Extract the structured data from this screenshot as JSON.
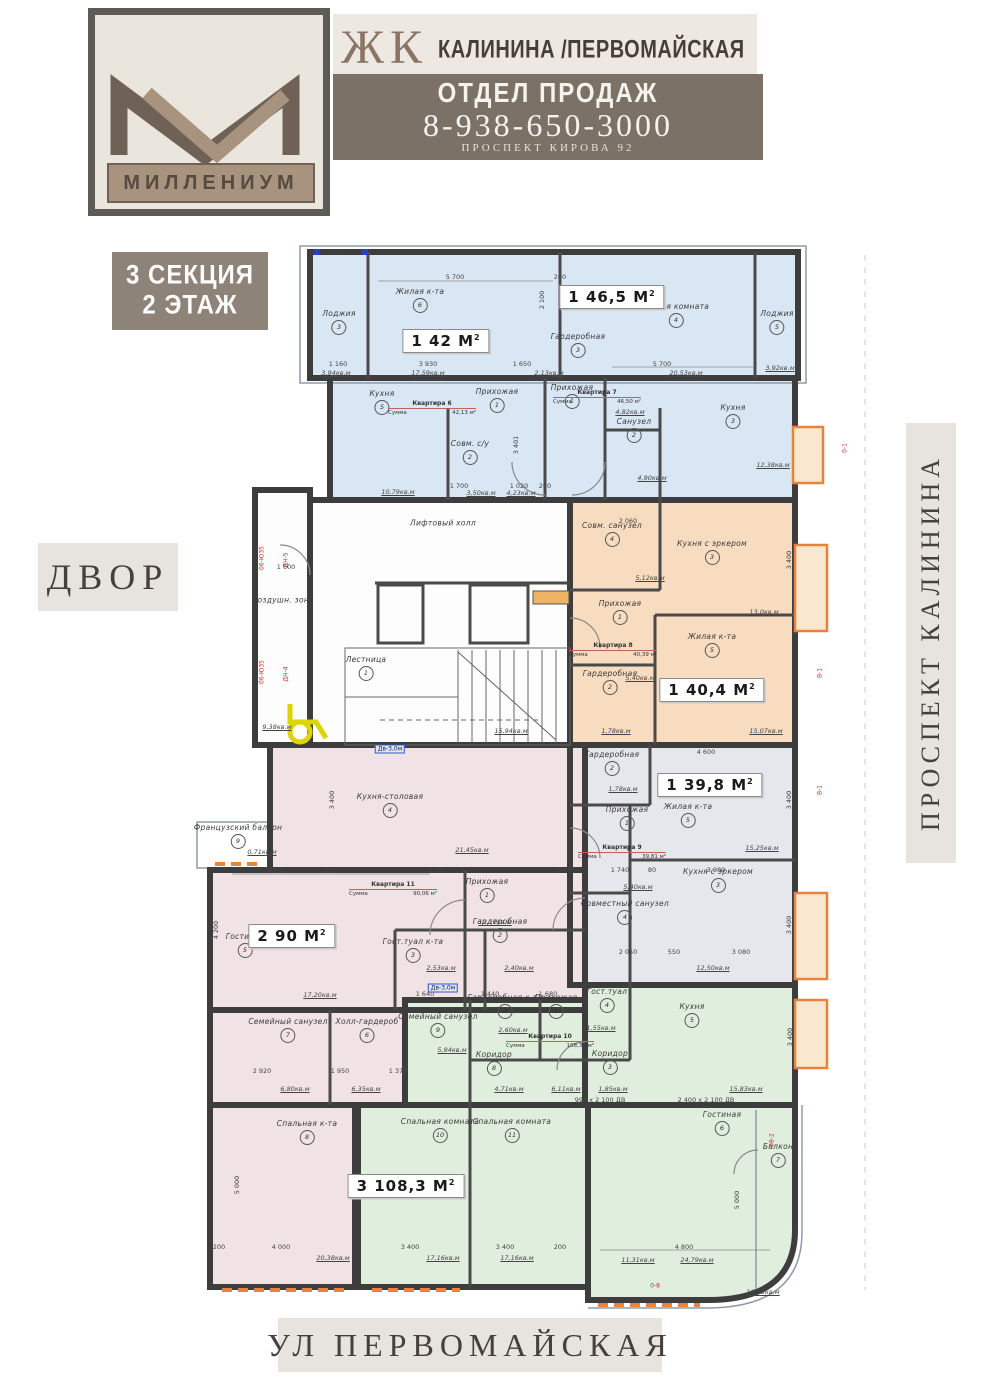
{
  "header": {
    "brand": "МИЛЛЕНИУМ",
    "complex_prefix": "ЖК",
    "complex_name": "КАЛИНИНА /ПЕРВОМАЙСКАЯ",
    "dept": "ОТДЕЛ ПРОДАЖ",
    "phone": "8-938-650-3000",
    "address": "ПРОСПЕКТ КИРОВА 92",
    "band_color": "#7b7166",
    "logo_dark": "#6f6156",
    "logo_taupe": "#a8937e"
  },
  "labels": {
    "section_line1": "3 СЕКЦИЯ",
    "section_line2": "2 ЭТАЖ",
    "left_street": "ДВОР",
    "right_street": "ПРОСПЕКТ КАЛИНИНА",
    "bottom_street": "УЛ ПЕРВОМАЙСКАЯ"
  },
  "plan": {
    "colors": {
      "blue": "#d9e6f3",
      "orange": "#f7dcc0",
      "gray": "#e6e6ed",
      "pink": "#f1e3e5",
      "green": "#dfeedd",
      "wall": "#3d3d3d",
      "accent_orange": "#e8823c"
    },
    "apartments": [
      {
        "key": "kv6",
        "title": "Квартира 6",
        "sum_label": "Сумма",
        "sum_value": "42,13 м²",
        "badge": "1 42 М",
        "badge_sup": "2"
      },
      {
        "key": "kv7",
        "title": "Квартира 7",
        "sum_label": "Сумма",
        "sum_value": "46,50 м²",
        "badge": "1 46,5 М",
        "badge_sup": "2"
      },
      {
        "key": "kv8",
        "title": "Квартира 8",
        "sum_label": "Сумма",
        "sum_value": "40,39 м²",
        "badge": "1 40,4 М",
        "badge_sup": "2"
      },
      {
        "key": "kv9",
        "title": "Квартира 9",
        "sum_label": "Сумма",
        "sum_value": "39,81 м²",
        "badge": "1 39,8 М",
        "badge_sup": "2"
      },
      {
        "key": "kv11",
        "title": "Квартира 11",
        "sum_label": "Сумма",
        "sum_value": "90,06 м²",
        "badge": "2 90 М",
        "badge_sup": "2"
      },
      {
        "key": "kv10",
        "title": "Квартира 10",
        "sum_label": "Сумма",
        "sum_value": "108,30 м²",
        "badge": "3 108,3 М",
        "badge_sup": "2"
      }
    ],
    "room_labels": [
      {
        "apt": "kv6",
        "x": 420,
        "y": 300,
        "num": "6",
        "name": "Жилая к-та"
      },
      {
        "apt": "kv6",
        "x": 339,
        "y": 322,
        "num": "3",
        "name": "Лоджия"
      },
      {
        "apt": "kv6",
        "x": 382,
        "y": 402,
        "num": "5",
        "name": "Кухня"
      },
      {
        "apt": "kv6",
        "x": 497,
        "y": 400,
        "num": "1",
        "name": "Прихожая"
      },
      {
        "apt": "kv6",
        "x": 470,
        "y": 452,
        "num": "2",
        "name": "Совм. с/у"
      },
      {
        "apt": "kv6",
        "x": 578,
        "y": 345,
        "num": "3",
        "name": "Гардеробная"
      },
      {
        "apt": "kv7",
        "x": 676,
        "y": 315,
        "num": "4",
        "name": "Жилая комната"
      },
      {
        "apt": "kv7",
        "x": 777,
        "y": 322,
        "num": "5",
        "name": "Лоджия"
      },
      {
        "apt": "kv7",
        "x": 572,
        "y": 396,
        "num": "1",
        "name": "Прихожая"
      },
      {
        "apt": "kv7",
        "x": 634,
        "y": 430,
        "num": "2",
        "name": "Санузел"
      },
      {
        "apt": "kv7",
        "x": 733,
        "y": 416,
        "num": "3",
        "name": "Кухня"
      },
      {
        "apt": "kv8",
        "x": 612,
        "y": 534,
        "num": "4",
        "name": "Совм. санузел"
      },
      {
        "apt": "kv8",
        "x": 712,
        "y": 552,
        "num": "3",
        "name": "Кухня с эркером"
      },
      {
        "apt": "kv8",
        "x": 620,
        "y": 612,
        "num": "1",
        "name": "Прихожая"
      },
      {
        "apt": "kv8",
        "x": 712,
        "y": 645,
        "num": "5",
        "name": "Жилая к-та"
      },
      {
        "apt": "kv8",
        "x": 610,
        "y": 682,
        "num": "2",
        "name": "Гардеробная"
      },
      {
        "apt": "kv9",
        "x": 612,
        "y": 763,
        "num": "2",
        "name": "Гардеробная"
      },
      {
        "apt": "kv9",
        "x": 688,
        "y": 815,
        "num": "5",
        "name": "Жилая к-та"
      },
      {
        "apt": "kv9",
        "x": 627,
        "y": 818,
        "num": "1",
        "name": "Прихожая"
      },
      {
        "apt": "kv9",
        "x": 718,
        "y": 880,
        "num": "3",
        "name": "Кухня с эркером"
      },
      {
        "apt": "kv9",
        "x": 625,
        "y": 912,
        "num": "4",
        "name": "Совместный санузел"
      },
      {
        "apt": "kv11",
        "x": 390,
        "y": 805,
        "num": "4",
        "name": "Кухня-столовая"
      },
      {
        "apt": "kv11",
        "x": 245,
        "y": 945,
        "num": "5",
        "name": "Гостиная"
      },
      {
        "apt": "kv11",
        "x": 487,
        "y": 890,
        "num": "1",
        "name": "Прихожая"
      },
      {
        "apt": "kv11",
        "x": 413,
        "y": 950,
        "num": "3",
        "name": "Гост.туал к-та"
      },
      {
        "apt": "kv11",
        "x": 500,
        "y": 930,
        "num": "2",
        "name": "Гардеробная"
      },
      {
        "apt": "kv11",
        "x": 288,
        "y": 1030,
        "num": "7",
        "name": "Семейный санузел"
      },
      {
        "apt": "kv11",
        "x": 367,
        "y": 1030,
        "num": "6",
        "name": "Холл-гардероб"
      },
      {
        "apt": "kv11",
        "x": 307,
        "y": 1132,
        "num": "8",
        "name": "Спальная к-та"
      },
      {
        "apt": "kv10",
        "x": 438,
        "y": 1025,
        "num": "9",
        "name": "Семейный санузел"
      },
      {
        "apt": "kv10",
        "x": 505,
        "y": 1006,
        "num": "2",
        "name": "Гардеробная к-та"
      },
      {
        "apt": "kv10",
        "x": 556,
        "y": 1006,
        "num": "1",
        "name": "Прихожая"
      },
      {
        "apt": "kv10",
        "x": 494,
        "y": 1063,
        "num": "8",
        "name": "Коридор"
      },
      {
        "apt": "kv10",
        "x": 607,
        "y": 1000,
        "num": "4",
        "name": "Гост.туал"
      },
      {
        "apt": "kv10",
        "x": 692,
        "y": 1015,
        "num": "5",
        "name": "Кухня"
      },
      {
        "apt": "kv10",
        "x": 610,
        "y": 1062,
        "num": "3",
        "name": "Коридор"
      },
      {
        "apt": "kv10",
        "x": 440,
        "y": 1130,
        "num": "10",
        "name": "Спальная комната"
      },
      {
        "apt": "kv10",
        "x": 512,
        "y": 1130,
        "num": "11",
        "name": "Спальная комната"
      },
      {
        "apt": "kv10",
        "x": 722,
        "y": 1123,
        "num": "6",
        "name": "Гостиная"
      },
      {
        "apt": "kv10",
        "x": 778,
        "y": 1155,
        "num": "7",
        "name": "Балкон"
      },
      {
        "apt": "common",
        "x": 443,
        "y": 523,
        "num": "",
        "name": "Лифтовый холл"
      },
      {
        "apt": "common",
        "x": 366,
        "y": 668,
        "num": "1",
        "name": "Лестница"
      },
      {
        "apt": "common",
        "x": 283,
        "y": 600,
        "num": "",
        "name": "Воздушн. зона"
      },
      {
        "apt": "common",
        "x": 238,
        "y": 836,
        "num": "9",
        "name": "Французский балкон"
      }
    ],
    "dim_labels": [
      {
        "t": "5 700",
        "x": 455,
        "y": 277
      },
      {
        "t": "200",
        "x": 560,
        "y": 277
      },
      {
        "t": "2 100",
        "x": 542,
        "y": 300,
        "r": 1
      },
      {
        "t": "1 160",
        "x": 338,
        "y": 364
      },
      {
        "t": "3 930",
        "x": 428,
        "y": 364
      },
      {
        "t": "17,59кв.м",
        "x": 428,
        "y": 373,
        "u": 1
      },
      {
        "t": "3,94кв.м",
        "x": 336,
        "y": 373,
        "u": 1
      },
      {
        "t": "1 650",
        "x": 522,
        "y": 364
      },
      {
        "t": "2,13кв.м",
        "x": 549,
        "y": 373,
        "u": 1
      },
      {
        "t": "5 700",
        "x": 662,
        "y": 364
      },
      {
        "t": "20,53кв.м",
        "x": 686,
        "y": 373,
        "u": 1
      },
      {
        "t": "3,92кв.м",
        "x": 780,
        "y": 368,
        "u": 1
      },
      {
        "t": "1 700",
        "x": 459,
        "y": 486
      },
      {
        "t": "1 020",
        "x": 519,
        "y": 486
      },
      {
        "t": "200",
        "x": 545,
        "y": 486
      },
      {
        "t": "10,79кв.м",
        "x": 398,
        "y": 492,
        "u": 1
      },
      {
        "t": "3,50кв.м",
        "x": 481,
        "y": 493,
        "u": 1
      },
      {
        "t": "4,23кв.м",
        "x": 521,
        "y": 493,
        "u": 1
      },
      {
        "t": "3 401",
        "x": 516,
        "y": 445,
        "r": 1
      },
      {
        "t": "4,82кв.м",
        "x": 630,
        "y": 412,
        "u": 1
      },
      {
        "t": "4,90кв.м",
        "x": 652,
        "y": 478,
        "u": 1
      },
      {
        "t": "12,38кв.м",
        "x": 773,
        "y": 465,
        "u": 1
      },
      {
        "t": "1 600",
        "x": 286,
        "y": 567
      },
      {
        "t": "9,38кв.м",
        "x": 277,
        "y": 727,
        "u": 1
      },
      {
        "t": "15,94кв.м",
        "x": 511,
        "y": 731,
        "u": 1
      },
      {
        "t": "2 060",
        "x": 628,
        "y": 521
      },
      {
        "t": "5,12кв.м",
        "x": 650,
        "y": 578,
        "u": 1
      },
      {
        "t": "13,0кв.м",
        "x": 764,
        "y": 612,
        "u": 1
      },
      {
        "t": "5,40кв.м",
        "x": 640,
        "y": 678,
        "u": 1
      },
      {
        "t": "1,78кв.м",
        "x": 616,
        "y": 731,
        "u": 1
      },
      {
        "t": "15,07кв.м",
        "x": 766,
        "y": 731,
        "u": 1
      },
      {
        "t": "3 400",
        "x": 789,
        "y": 560,
        "r": 1
      },
      {
        "t": "4 600",
        "x": 706,
        "y": 752
      },
      {
        "t": "1,78кв.м",
        "x": 623,
        "y": 789,
        "u": 1
      },
      {
        "t": "3 400",
        "x": 789,
        "y": 800,
        "r": 1
      },
      {
        "t": "15,25кв.м",
        "x": 762,
        "y": 848,
        "u": 1
      },
      {
        "t": "1 740",
        "x": 620,
        "y": 870
      },
      {
        "t": "80",
        "x": 652,
        "y": 870
      },
      {
        "t": "3 980",
        "x": 716,
        "y": 870
      },
      {
        "t": "5,40кв.м",
        "x": 638,
        "y": 887,
        "u": 1
      },
      {
        "t": "2 050",
        "x": 628,
        "y": 952
      },
      {
        "t": "550",
        "x": 674,
        "y": 952
      },
      {
        "t": "3 080",
        "x": 741,
        "y": 952
      },
      {
        "t": "12,50кв.м",
        "x": 713,
        "y": 968,
        "u": 1
      },
      {
        "t": "3 400",
        "x": 789,
        "y": 925,
        "r": 1
      },
      {
        "t": "3 400",
        "x": 332,
        "y": 800,
        "r": 1
      },
      {
        "t": "21,45кв.м",
        "x": 472,
        "y": 850,
        "u": 1
      },
      {
        "t": "4 000",
        "x": 277,
        "y": 871
      },
      {
        "t": "200",
        "x": 330,
        "y": 871
      },
      {
        "t": "5 200",
        "x": 437,
        "y": 871
      },
      {
        "t": "200",
        "x": 560,
        "y": 871
      },
      {
        "t": "0,71кв.м",
        "x": 262,
        "y": 852,
        "u": 1
      },
      {
        "t": "12,17кв.м",
        "x": 495,
        "y": 922,
        "u": 1
      },
      {
        "t": "2,40кв.м",
        "x": 519,
        "y": 968,
        "u": 1
      },
      {
        "t": "2,53кв.м",
        "x": 441,
        "y": 968,
        "u": 1
      },
      {
        "t": "17,20кв.м",
        "x": 320,
        "y": 995,
        "u": 1
      },
      {
        "t": "4 200",
        "x": 216,
        "y": 930,
        "r": 1
      },
      {
        "t": "2 920",
        "x": 262,
        "y": 1071
      },
      {
        "t": "1 950",
        "x": 340,
        "y": 1071
      },
      {
        "t": "1 370",
        "x": 398,
        "y": 1071
      },
      {
        "t": "6,80кв.м",
        "x": 295,
        "y": 1089,
        "u": 1
      },
      {
        "t": "6,35кв.м",
        "x": 366,
        "y": 1089,
        "u": 1
      },
      {
        "t": "5,94кв.м",
        "x": 452,
        "y": 1050,
        "u": 1
      },
      {
        "t": "1 640",
        "x": 425,
        "y": 994
      },
      {
        "t": "1 440",
        "x": 490,
        "y": 994
      },
      {
        "t": "1 680",
        "x": 548,
        "y": 994
      },
      {
        "t": "2,60кв.м",
        "x": 513,
        "y": 1030,
        "u": 1
      },
      {
        "t": "4,71кв.м",
        "x": 509,
        "y": 1089,
        "u": 1
      },
      {
        "t": "6,11кв.м",
        "x": 566,
        "y": 1089,
        "u": 1
      },
      {
        "t": "1,55кв.м",
        "x": 601,
        "y": 1028,
        "u": 1
      },
      {
        "t": "1,85кв.м",
        "x": 613,
        "y": 1089,
        "u": 1
      },
      {
        "t": "15,83кв.м",
        "x": 746,
        "y": 1089,
        "u": 1
      },
      {
        "t": "3 400",
        "x": 790,
        "y": 1037,
        "r": 1
      },
      {
        "t": "990 x 2 100 ДВ",
        "x": 600,
        "y": 1100
      },
      {
        "t": "2 400 x 2 100 ДВ",
        "x": 706,
        "y": 1100
      },
      {
        "t": "5 000",
        "x": 237,
        "y": 1185,
        "r": 1
      },
      {
        "t": "5 000",
        "x": 737,
        "y": 1200,
        "r": 1
      },
      {
        "t": "200",
        "x": 219,
        "y": 1247
      },
      {
        "t": "4 000",
        "x": 281,
        "y": 1247
      },
      {
        "t": "20,38кв.м",
        "x": 333,
        "y": 1258,
        "u": 1
      },
      {
        "t": "3 400",
        "x": 410,
        "y": 1247
      },
      {
        "t": "17,16кв.м",
        "x": 443,
        "y": 1258,
        "u": 1
      },
      {
        "t": "3 400",
        "x": 505,
        "y": 1247
      },
      {
        "t": "17,16кв.м",
        "x": 517,
        "y": 1258,
        "u": 1
      },
      {
        "t": "200",
        "x": 560,
        "y": 1247
      },
      {
        "t": "4 800",
        "x": 684,
        "y": 1247
      },
      {
        "t": "11,31кв.м",
        "x": 638,
        "y": 1260,
        "u": 1
      },
      {
        "t": "24,79кв.м",
        "x": 697,
        "y": 1260,
        "u": 1
      },
      {
        "t": "10,93кв.м",
        "x": 763,
        "y": 1292,
        "u": 1
      }
    ],
    "red_marks": [
      {
        "t": "06-Ю35",
        "x": 262,
        "y": 558,
        "r": 1
      },
      {
        "t": "ДН-5",
        "x": 286,
        "y": 560,
        "r": 1
      },
      {
        "t": "06-Ю35",
        "x": 262,
        "y": 672,
        "r": 1
      },
      {
        "t": "ДН-4",
        "x": 286,
        "y": 674,
        "r": 1
      },
      {
        "t": "0-1",
        "x": 845,
        "y": 448,
        "r": 1
      },
      {
        "t": "В-1",
        "x": 820,
        "y": 673,
        "r": 1
      },
      {
        "t": "В-1",
        "x": 820,
        "y": 790,
        "r": 1
      },
      {
        "t": "08-2",
        "x": 772,
        "y": 1140,
        "r": 1
      },
      {
        "t": "0-8",
        "x": 655,
        "y": 1286
      }
    ],
    "tag_boxes": [
      {
        "t": "Дв-3,0м",
        "x": 390,
        "y": 749
      },
      {
        "t": "Дв-3,0м",
        "x": 443,
        "y": 988
      }
    ]
  }
}
